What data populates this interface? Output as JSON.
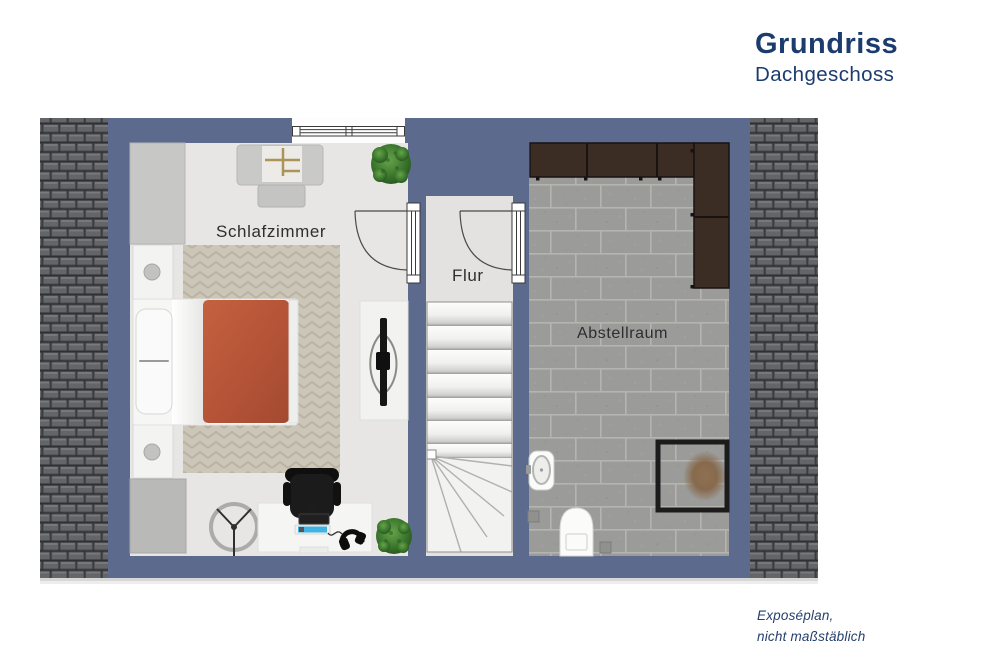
{
  "header": {
    "title": "Grundriss",
    "subtitle": "Dachgeschoss"
  },
  "rooms": {
    "bedroom": {
      "label": "Schlafzimmer"
    },
    "hallway": {
      "label": "Flur"
    },
    "storage": {
      "label": "Abstellraum"
    }
  },
  "footer": {
    "line1": "Exposéplan,",
    "line2": "nicht maßstäblich"
  },
  "colors": {
    "title_navy": "#1d3c6e",
    "wall_blue": "#5c6a8d",
    "roof_tile_gray": "#646568",
    "bedroom_floor": "#e7e6e4",
    "hallway_floor": "#e3e2e0",
    "storage_floor": "#9b9b99",
    "blanket_terracotta": "#b65438",
    "cabinet_brown": "#3c2d24",
    "plant_green": "#3f7c30",
    "rug_beige": "#ccc6b8"
  },
  "plan_elements": [
    "roof-left",
    "roof-right",
    "exterior-walls",
    "window",
    "door-bedroom",
    "door-storage",
    "stairs-with-winder",
    "wardrobe",
    "armchair-with-tray",
    "ottoman",
    "bed",
    "pillow",
    "nightstand-top",
    "nightstand-bottom",
    "herringbone-rug",
    "tv-sideboard",
    "ceiling-fan",
    "desk",
    "office-chair",
    "keyboard",
    "laptop",
    "headphones",
    "plant-top",
    "plant-bottom",
    "corner-closet",
    "storage-cabinets",
    "sink",
    "toilet",
    "floor-drains",
    "pet-bed-frame"
  ]
}
